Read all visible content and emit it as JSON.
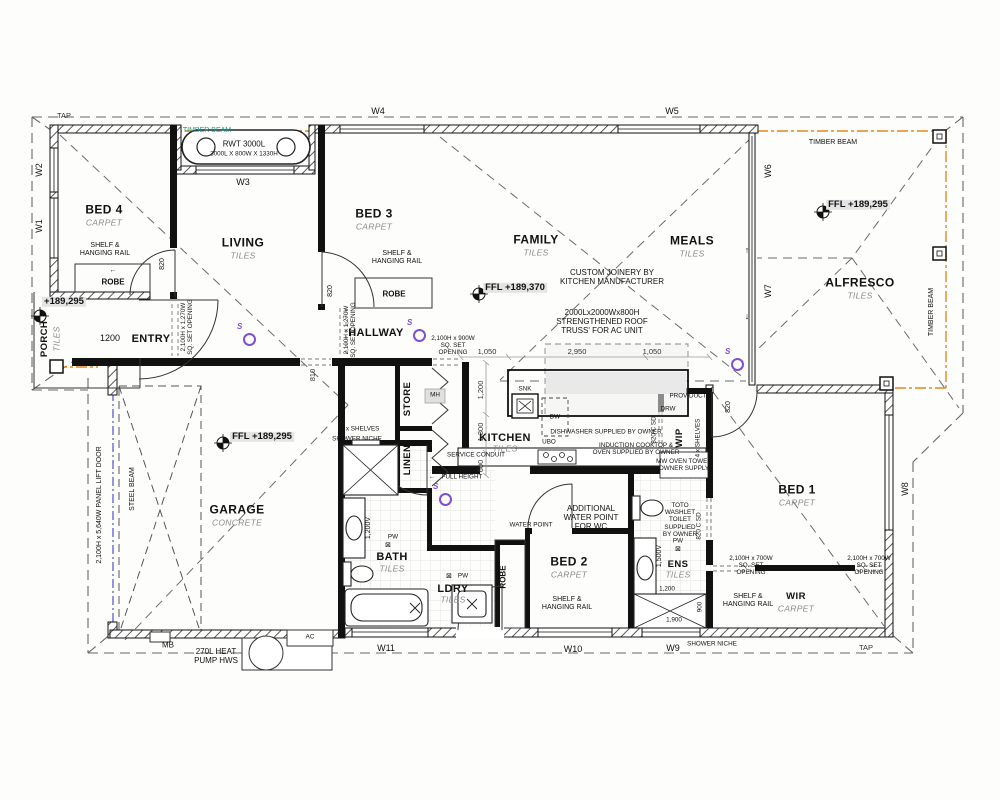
{
  "rooms": {
    "bed4": {
      "name": "BED 4",
      "finish": "CARPET"
    },
    "living": {
      "name": "LIVING",
      "finish": "TILES"
    },
    "bed3": {
      "name": "BED 3",
      "finish": "CARPET"
    },
    "family": {
      "name": "FAMILY",
      "finish": "TILES"
    },
    "meals": {
      "name": "MEALS",
      "finish": "TILES"
    },
    "alfresco": {
      "name": "ALFRESCO",
      "finish": "TILES"
    },
    "porch": {
      "name": "PORCH",
      "finish": "TILES"
    },
    "entry": {
      "name": "ENTRY"
    },
    "hallway": {
      "name": "HALLWAY"
    },
    "garage": {
      "name": "GARAGE",
      "finish": "CONCRETE"
    },
    "kitchen": {
      "name": "KITCHEN",
      "finish": "TILES"
    },
    "store": {
      "name": "STORE"
    },
    "linen": {
      "name": "LINEN"
    },
    "bath": {
      "name": "BATH",
      "finish": "TILES"
    },
    "ldry": {
      "name": "LDRY",
      "finish": "TILES"
    },
    "bed2": {
      "name": "BED 2",
      "finish": "CARPET"
    },
    "ens": {
      "name": "ENS",
      "finish": "TILES"
    },
    "wip": {
      "name": "WIP"
    },
    "bed1": {
      "name": "BED 1",
      "finish": "CARPET"
    },
    "wir": {
      "name": "WIR",
      "finish": "CARPET"
    }
  },
  "windows": {
    "w1": "W1",
    "w2": "W2",
    "w3": "W3",
    "w4": "W4",
    "w5": "W5",
    "w6": "W6",
    "w7": "W7",
    "w8": "W8",
    "w9": "W9",
    "w10": "W10",
    "w11": "W11"
  },
  "levels": {
    "family_ffl": "FFL +189,370",
    "garage_ffl": "FFL +189,295",
    "alfresco_ffl": "FFL +189,295",
    "porch_rl": "+189,295"
  },
  "annotations": {
    "tap": "TAP",
    "timber_beam": "TIMBER BEAM",
    "rwt_line1": "RWT 3000L",
    "rwt_line2": "3000L X 800W X 1330H",
    "robe": "ROBE",
    "shelf_rail": "SHELF &\nHANGING RAIL",
    "sq_set_1270": "2,100H x 1,270W\nSQ. SET OPENING",
    "sq_set_900": "2,100H x 900W\nSQ. SET\nOPENING",
    "sq_set_700": "2,100H x 700W\nSQ. SET\nOPENING",
    "panel_lift_door": "2,100H x 5,640W PANEL LIFT DOOR",
    "steel_beam": "STEEL BEAM",
    "custom_joinery": "CUSTOM JOINERY BY\nKITCHEN MANUFACTURER",
    "roof_truss": "2000Lx2000Wx800H\nSTRENGTHENED ROOF\nTRUSS' FOR AC UNIT",
    "dishwasher": "DISHWASHER SUPPLIED BY OWNER",
    "induction": "INDUCTION COOKTOP &\nOVEN SUPPLIED BY OWNER",
    "mw_oven": "MW OVEN TOWER\nOWNER SUPPLY",
    "service_conduit": "SERVICE CONDUIT",
    "full_height": "FULL HEIGHT",
    "shelves_4": "4 x SHELVES",
    "shower_niche": "SHOWER NICHE",
    "prov_duct": "PROV DUCT",
    "toto": "TOTO\nWASHLET\nTOILET\nSUPPLIED\nBY OWNER",
    "water_point": "WATER POINT",
    "additional_wp": "ADDITIONAL\nWATER POINT\nFOR WC",
    "mb": "MB",
    "hws": "270L HEAT\nPUMP HWS",
    "ac": "AC",
    "snk": "SNK",
    "dw": "DW",
    "drw": "DRW",
    "ubo": "UBO",
    "mh": "MH",
    "csd": "820 C SD",
    "smoke": "S",
    "arrow_up": "↑",
    "arrow_down": "↓",
    "arrow_left": "←"
  },
  "dims": {
    "entry_door": "1200",
    "garage_opening": "810",
    "swing_door": "820",
    "k1": "1,050",
    "k2": "2,950",
    "k3": "1,050",
    "kv1": "1,200",
    "kv2": "1,300",
    "kv3": "600",
    "bath_vanity": "1,200V",
    "ens_vanity": "1,500V",
    "ens_1200": "1,200",
    "ens_1900": "1,900",
    "ens_900": "900",
    "pw": "PW",
    "pw_symbol": "⊠"
  }
}
